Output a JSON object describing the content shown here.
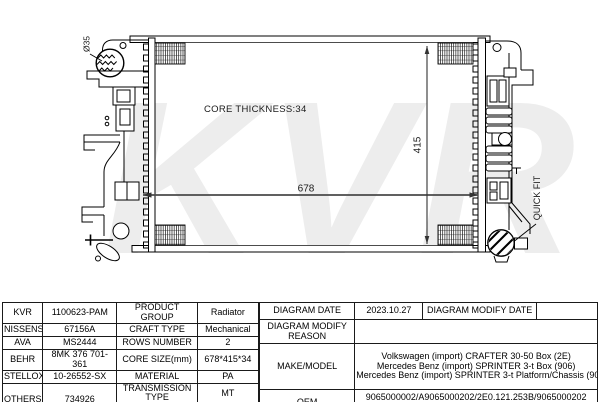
{
  "drawing": {
    "watermark": "KVR",
    "core_thickness_label": "CORE THICKNESS:34",
    "width_dimension": "678",
    "height_dimension": "415",
    "inlet_diameter_label": "Ø35",
    "quick_fit_label": "QUICK FIT"
  },
  "table": {
    "crossref": {
      "rows": [
        {
          "brand": "KVR",
          "number": "1100623-PAM"
        },
        {
          "brand": "NISSENS",
          "number": "67156A"
        },
        {
          "brand": "AVA",
          "number": "MS2444"
        },
        {
          "brand": "BEHR",
          "number": "8MK 376 701-361"
        },
        {
          "brand": "STELLOX",
          "number": "10-26552-SX"
        },
        {
          "brand": "OTHERS",
          "number": "734926"
        }
      ]
    },
    "specs": {
      "product_group_label": "PRODUCT GROUP",
      "product_group": "Radiator",
      "craft_type_label": "CRAFT TYPE",
      "craft_type": "Mechanical",
      "rows_number_label": "ROWS NUMBER",
      "rows_number": "2",
      "core_size_label": "CORE SIZE(mm)",
      "core_size": "678*415*34",
      "material_label": "MATERIAL",
      "material": "PA",
      "transmission_label": "TRANSMISSION TYPE",
      "transmission": "MT",
      "supplementary_label": "SUPPLEMENTARY",
      "supplementary": ""
    },
    "info": {
      "diagram_date_label": "DIAGRAM DATE",
      "diagram_date": "2023.10.27",
      "diagram_modify_date_label": "DIAGRAM MODIFY DATE",
      "diagram_modify_date": "",
      "diagram_modify_reason_label": "DIAGRAM MODIFY REASON",
      "diagram_modify_reason": "",
      "make_model_label": "MAKE/MODEL",
      "make_model": [
        "Volkswagen (import) CRAFTER 30-50 Box (2E)",
        "Mercedes Benz (import) SPRINTER 3-t Box (906)",
        "Mercedes Benz (import) SPRINTER 3-t Platform/Chassis (906)"
      ],
      "oem_label": "OEM",
      "oem": [
        "9065000002/A9065000202/2E0.121.253B/9065000202",
        "A9065000102/2E0.121.253A/A9065000002/9065000102"
      ]
    }
  }
}
